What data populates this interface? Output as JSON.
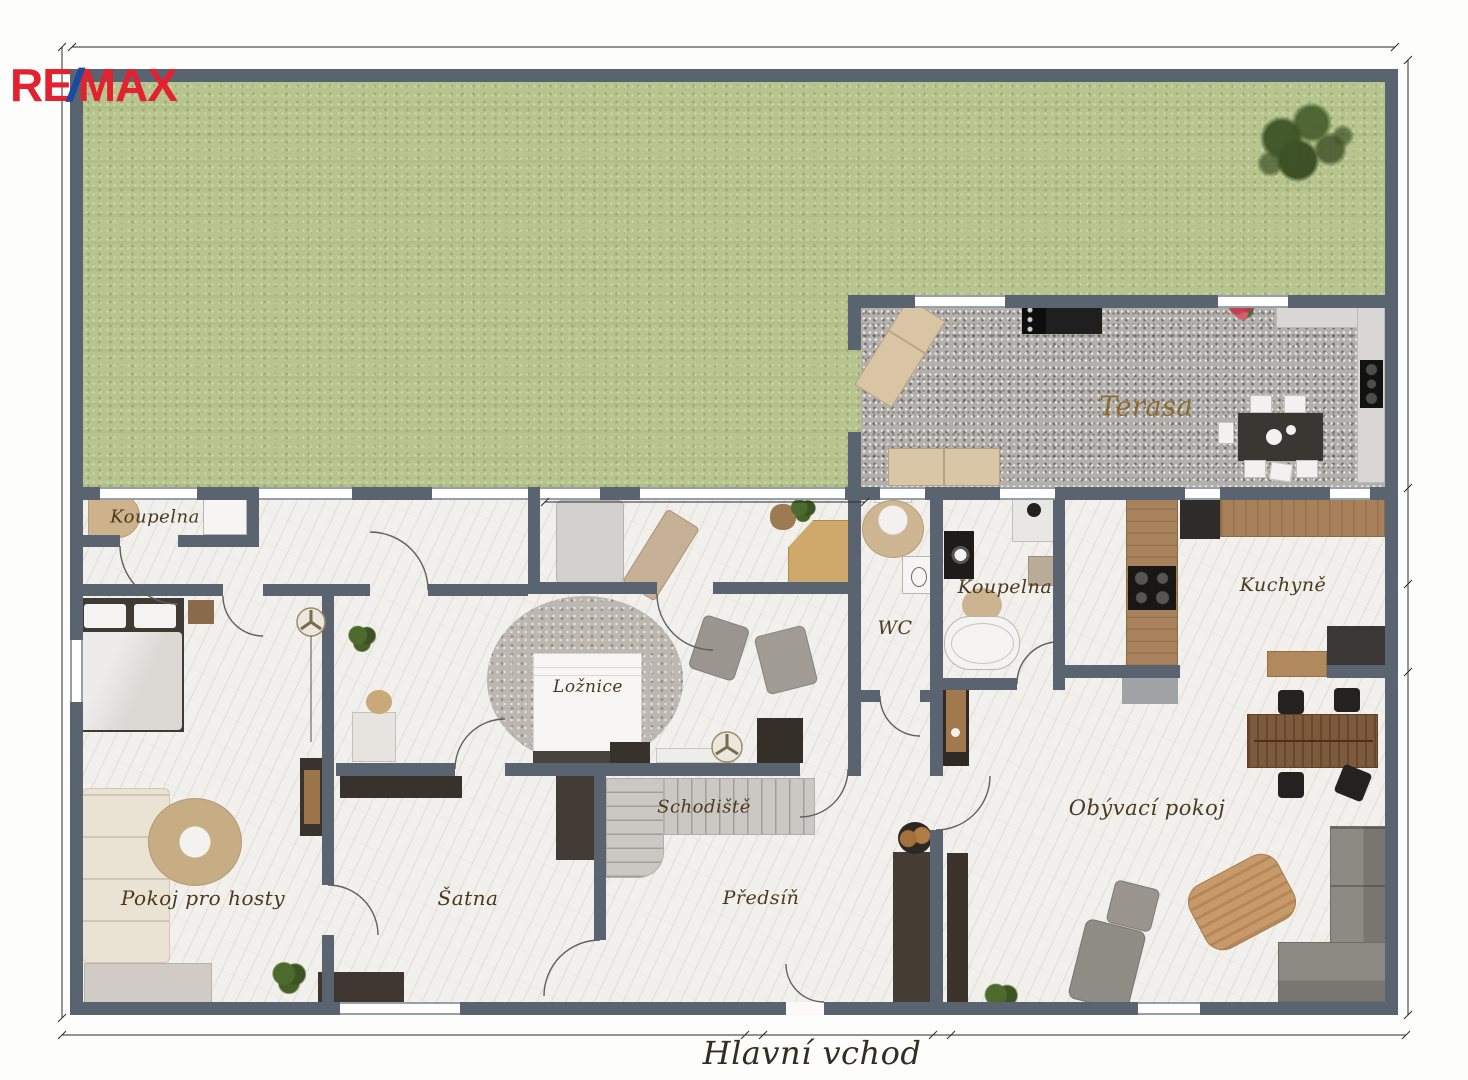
{
  "logo": {
    "re": "RE",
    "slash": "/",
    "max": "MAX"
  },
  "rooms": {
    "bathroom_top": "Koupelna",
    "terrace": "Terasa",
    "wc": "WC",
    "bathroom_middle": "Koupelna",
    "kitchen": "Kuchyně",
    "bedroom": "Ložnice",
    "staircase": "Schodiště",
    "hallway": "Předsíň",
    "guest_room": "Pokoj pro hosty",
    "wardrobe": "Šatna",
    "living_room": "Obývací pokoj"
  },
  "annotations": {
    "main_entrance": "Hlavní vchod"
  },
  "colors": {
    "remax_red": "#e2232f",
    "remax_blue": "#1b4aa2",
    "wall": "#5a6470",
    "grass": "#b7c48e",
    "gravel": "#b3b0ac",
    "floor": "#f2f0ec",
    "stairs": "#cbc8c3",
    "label_text": "#4a3921",
    "terrace_label_text": "#8a6a2e",
    "entrance_label_text": "#332c20"
  }
}
